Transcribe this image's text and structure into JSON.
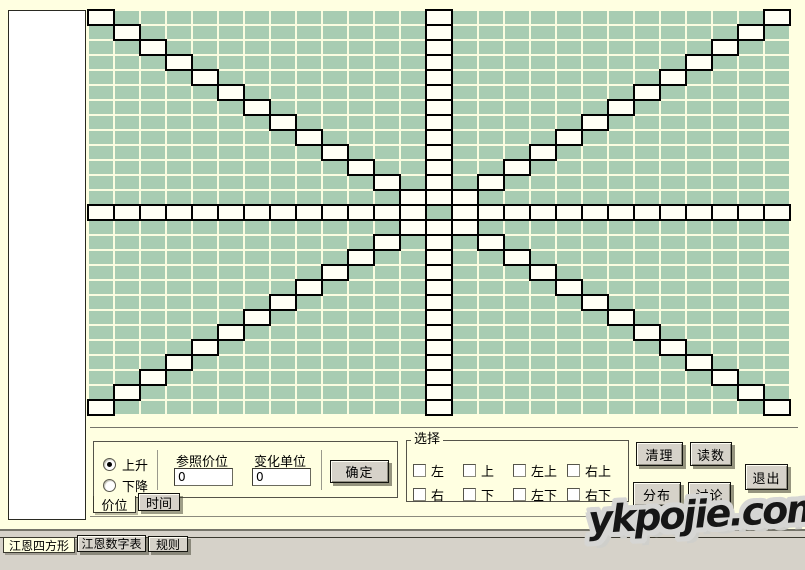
{
  "colors": {
    "bg": "#ffffe1",
    "panel_gray": "#d6d2c9",
    "grid_cell": "#a8ccb2",
    "grid_gap": "#fafce0",
    "grid_highlight": "#fffff5",
    "grid_border": "#000000"
  },
  "grid": {
    "rows": 27,
    "cols": 27,
    "center": 13,
    "pattern": "highlight cells on center row, center column, both main diagonals; center cell stays green with black border"
  },
  "controls": {
    "radio_up": "上升",
    "radio_down": "下降",
    "ref_price_label": "参照价位",
    "ref_price_value": "0",
    "unit_label": "变化单位",
    "unit_value": "0",
    "confirm_label": "确定",
    "tabs": [
      {
        "label": "价位",
        "active": true
      },
      {
        "label": "时间",
        "active": false
      }
    ]
  },
  "select_group": {
    "title": "选择",
    "row1": [
      "左",
      "上",
      "左上",
      "右上"
    ],
    "row2": [
      "右",
      "下",
      "左下",
      "右下"
    ]
  },
  "buttons": {
    "clean": "清理",
    "read": "读数",
    "distribution": "分布",
    "discuss": "讨论",
    "exit": "退出"
  },
  "bottom_tabs": [
    {
      "label": "江恩四方形",
      "active": true
    },
    {
      "label": "江恩数字表",
      "active": false
    },
    {
      "label": "规则",
      "active": false
    }
  ],
  "watermark": "ykpojie.com"
}
